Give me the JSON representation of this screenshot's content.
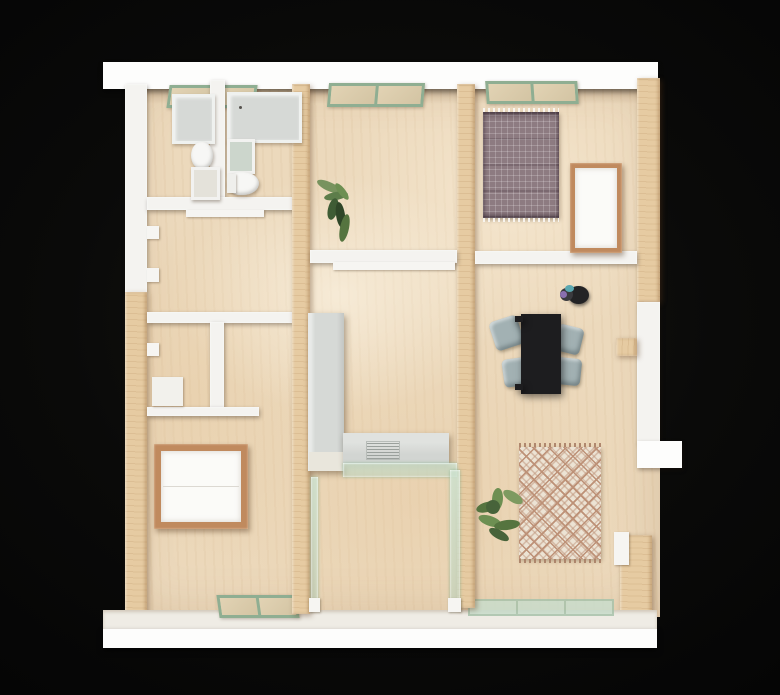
{
  "description": "Top-down photograph of a physical architectural scale model of an apartment floor plan, built from birch plywood with painted white walls and green-framed glazing, on a black background.",
  "colors": {
    "background": "#0a0a09",
    "wall_white": "#f4f3f0",
    "wall_white_bright": "#fdfdfc",
    "floor_plywood": "#ecd9bc",
    "wood_wall": "#e6cba2",
    "wood_frame": "#c08a5e",
    "window_green": "#8fae92",
    "glass_green": "#c9ddcc",
    "counter_gray": "#d6d9d6",
    "table_black": "#1d1d1f",
    "chair_gray": "#a2b1b3",
    "rug_plaid_base": "#8d7b81",
    "rug_diamond_base": "#ece3d4",
    "rug_diamond_pattern": "#bd9177",
    "plant_green": "#6d8f52",
    "plant_green_dark": "#47633a"
  },
  "scene": {
    "type": "architectural-model-photo",
    "view": "top-down",
    "structure": [
      "white perimeter walls top and bottom",
      "plywood interior partition walls",
      "green framed windows set into wall tops",
      "glass-walled room at bottom center",
      "balcony ledge opening on right wall"
    ],
    "rooms": [
      {
        "name": "bathroom-top-left",
        "objects": [
          "shower-tray",
          "vanity-counter",
          "toilet",
          "toilet",
          "wall-sink",
          "wall-sink"
        ]
      },
      {
        "name": "hall-with-shelves-left",
        "objects": [
          "wall-shelf-tabs"
        ]
      },
      {
        "name": "closet-left",
        "objects": [
          "storage-box",
          "shelf"
        ]
      },
      {
        "name": "bedroom-bottom-left",
        "objects": [
          "double-bed-wood-frame"
        ]
      },
      {
        "name": "living-area-upper-middle",
        "objects": [
          "plant"
        ]
      },
      {
        "name": "kitchen-middle",
        "objects": [
          "tall-gray-cabinet",
          "counter-with-cooktop",
          "glass-shelf"
        ]
      },
      {
        "name": "glass-room-bottom-middle",
        "objects": [
          "glass-partition-walls"
        ]
      },
      {
        "name": "bedroom-top-right",
        "objects": [
          "plaid-rug",
          "single-bed-wood-frame",
          "wall-shelf"
        ]
      },
      {
        "name": "dining-living-right",
        "objects": [
          "black-dining-table",
          "chair",
          "chair",
          "chair",
          "chair",
          "figurine",
          "diamond-pattern-rug",
          "plant",
          "balcony-ledge"
        ]
      }
    ]
  }
}
